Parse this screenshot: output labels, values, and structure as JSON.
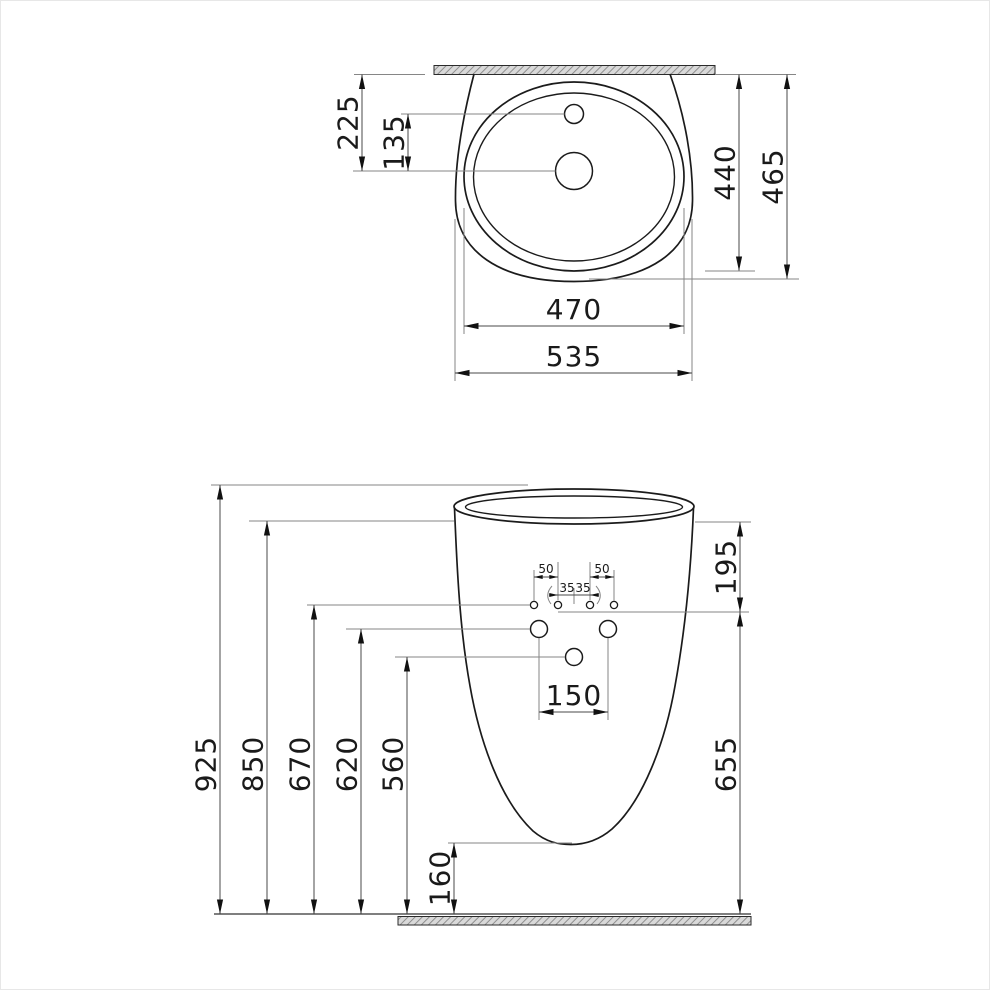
{
  "meta": {
    "drawing_type": "technical dimension drawing",
    "subject": "pedestal washbasin, top view and front view",
    "units": "mm",
    "background_color": "#ffffff",
    "line_color": "#1b1b1b",
    "dim_text_color": "#1a1a1a",
    "hatch_fill": "#d9d9d9",
    "hatch_stroke": "#8f8f8f"
  },
  "top_view": {
    "dims": {
      "wall_to_drain": "225",
      "faucet_to_drain": "135",
      "wall_to_bowl_rear": "440",
      "wall_to_front": "465",
      "bowl_width": "470",
      "overall_width": "535"
    }
  },
  "front_view": {
    "dims": {
      "overall_height": "925",
      "rim_bottom_height": "850",
      "fixing_holes_height": "670",
      "side_holes_height": "620",
      "center_hole_height": "560",
      "underside_clearance": "160",
      "rim_to_fixing_holes": "195",
      "fixing_holes_to_floor": "655",
      "side_holes_spacing": "150",
      "outer_hole_offset_left": "50",
      "outer_hole_offset_right": "50",
      "inner_hole_offset_left": "35",
      "inner_hole_offset_right": "35"
    }
  }
}
